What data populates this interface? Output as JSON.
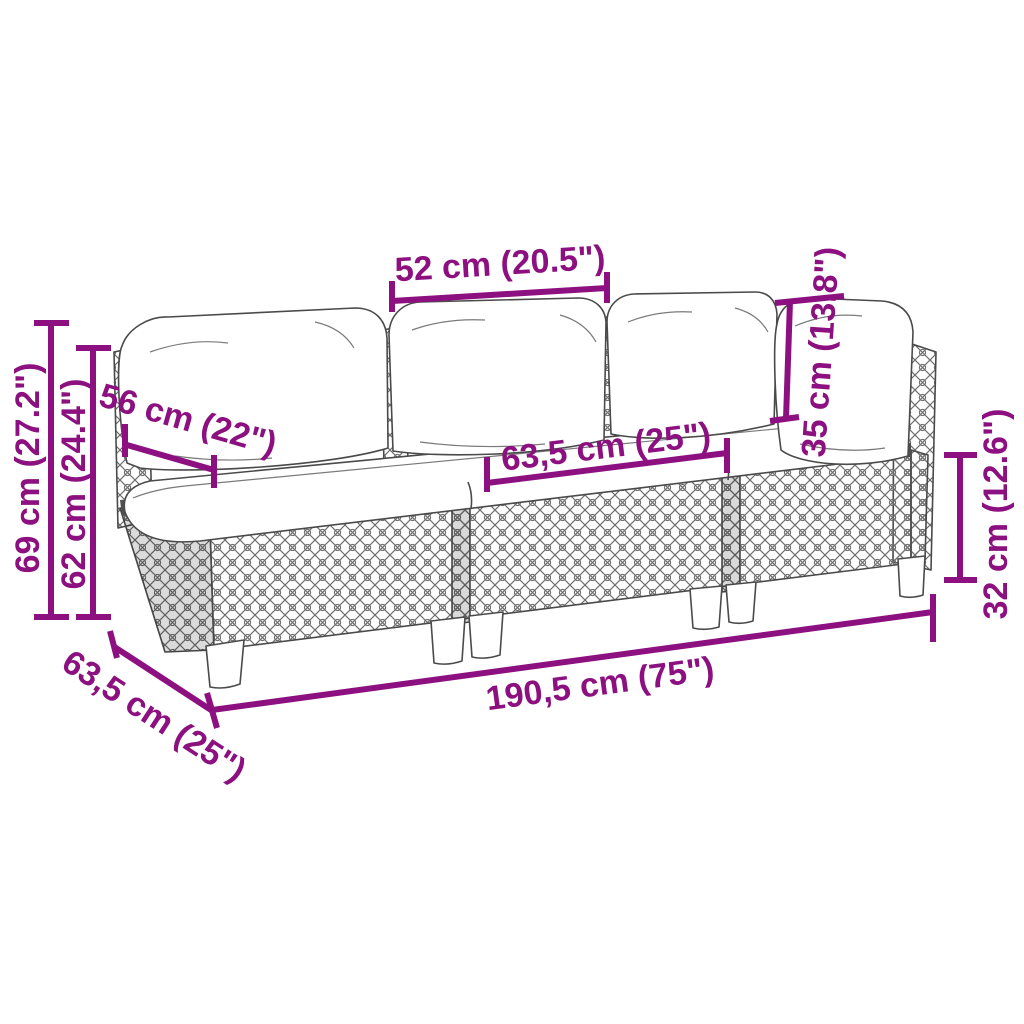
{
  "diagram": {
    "kind": "product-dimension-diagram",
    "product": "3-piece poly rattan garden sofa with cushions",
    "accent_color": "#8C107F",
    "line_art_color": "#4a4a4a"
  },
  "dimensions": {
    "cushion_width": {
      "label": "52 cm (20.5\")"
    },
    "backrest_height": {
      "label": "35 cm (13.8\")"
    },
    "overall_height": {
      "label": "69 cm (27.2\")"
    },
    "back_frame_height": {
      "label": "62 cm (24.4\")"
    },
    "top_depth": {
      "label": "56 cm (22\")"
    },
    "seat_cushion_width": {
      "label": "63,5 cm (25\")"
    },
    "seat_height": {
      "label": "32 cm (12.6\")"
    },
    "overall_width": {
      "label": "190,5 cm (75\")"
    },
    "overall_depth": {
      "label": "63,5 cm (25\")"
    }
  }
}
